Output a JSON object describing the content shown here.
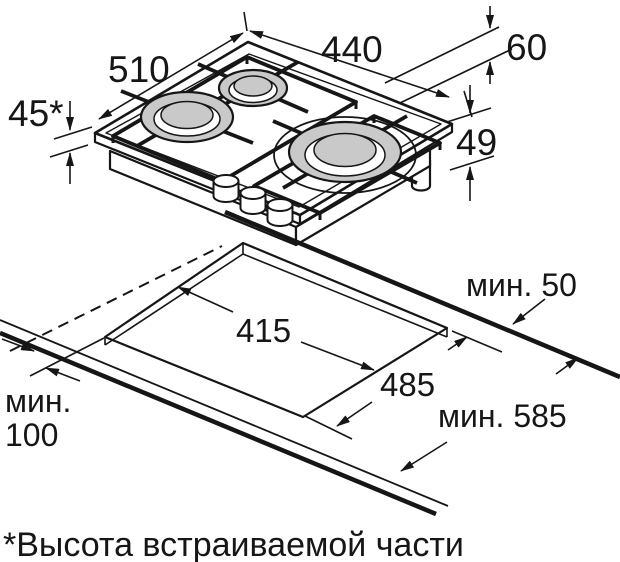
{
  "colors": {
    "background": "#ffffff",
    "line": "#161616",
    "burner_fill": "#c9c9c9"
  },
  "top_drawing": {
    "description": "isometric gas hob, 3 burners, 3 knobs",
    "labels": {
      "depth": "510",
      "width": "440",
      "offset_right": "60",
      "body_height": "49",
      "builtin_height": "45*"
    }
  },
  "cutout_drawing": {
    "description": "worktop cutout for built-in installation",
    "labels": {
      "cutout_width": "415",
      "cutout_depth": "485",
      "min_rear": "мин. 50",
      "min_depth": "мин. 585",
      "min_side_word": "мин.",
      "min_side_value": "100"
    }
  },
  "footnote": {
    "text": "*Высота встраиваемой части"
  }
}
